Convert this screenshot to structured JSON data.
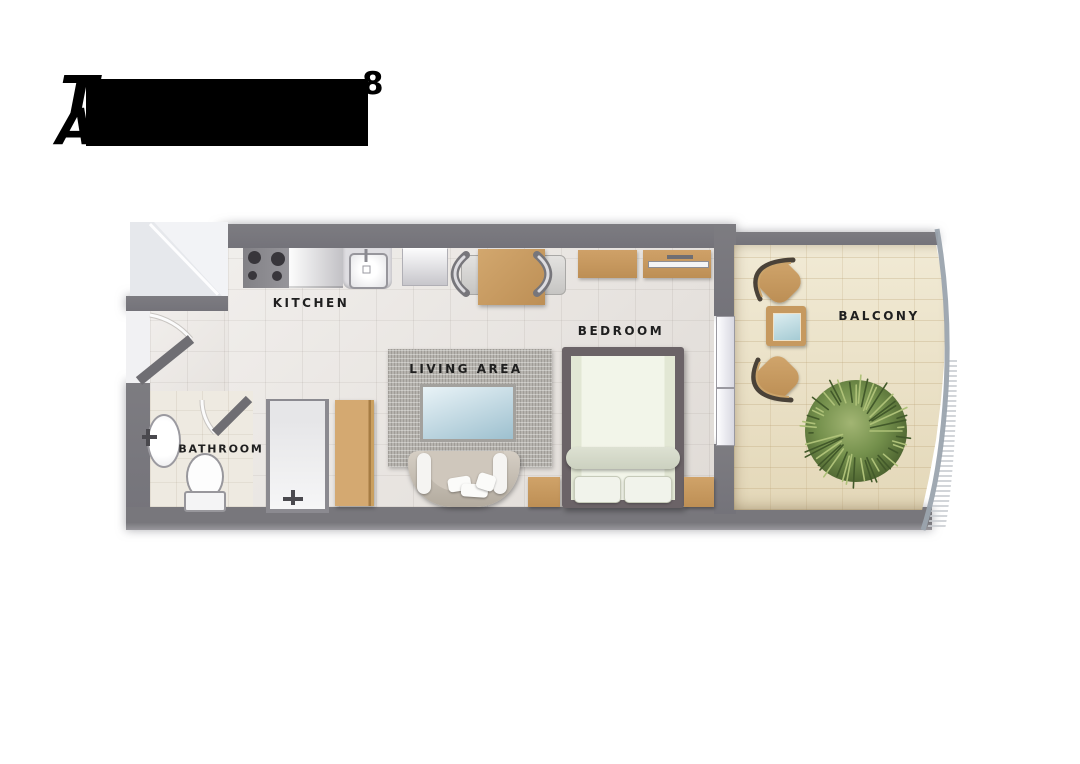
{
  "title": {
    "visible_fragment_line1": "T",
    "superscript": "8",
    "visible_fragment_line2": "A"
  },
  "rooms": {
    "kitchen": {
      "label": "KITCHEN"
    },
    "living": {
      "label": "LIVING AREA"
    },
    "bedroom": {
      "label": "BEDROOM"
    },
    "bathroom": {
      "label": "BATHROOM"
    },
    "balcony": {
      "label": "BALCONY"
    }
  },
  "colors": {
    "wall": "#78777c",
    "interior_floor": "#e9e5e1",
    "bathroom_floor": "#eeeae1",
    "balcony_floor": "#ece3c7",
    "wood": "#c89c63",
    "rug": "#b6b3ae",
    "glass": "#bcd7e0",
    "plant": "#6d8746",
    "railing": "#9ba4ae"
  }
}
